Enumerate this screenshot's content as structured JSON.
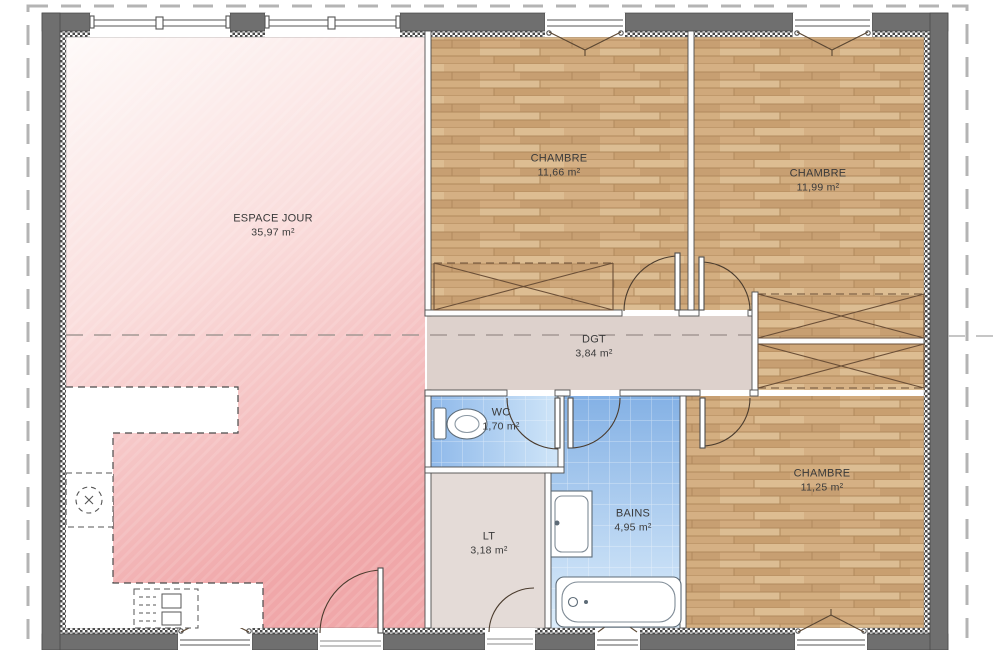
{
  "plan": {
    "rooms": [
      {
        "id": "espace-jour",
        "name": "ESPACE JOUR",
        "area": "35,97 m²"
      },
      {
        "id": "chambre-1",
        "name": "CHAMBRE",
        "area": "11,66 m²"
      },
      {
        "id": "chambre-2",
        "name": "CHAMBRE",
        "area": "11,99 m²"
      },
      {
        "id": "dgt",
        "name": "DGT",
        "area": "3,84 m²"
      },
      {
        "id": "wc",
        "name": "WC",
        "area": "1,70 m²"
      },
      {
        "id": "bains",
        "name": "BAINS",
        "area": "4,95 m²"
      },
      {
        "id": "lt",
        "name": "LT",
        "area": "3,18 m²"
      },
      {
        "id": "chambre-3",
        "name": "CHAMBRE",
        "area": "11,25 m²"
      }
    ],
    "colors": {
      "exterior_wall": "#6f6f6f",
      "living_pink": "#f2abad",
      "wood_floor": "#d2ab7e",
      "wet_room_blue": "#8ab5e8",
      "corridor": "#ddd1cc",
      "utility": "#e4dbd7",
      "boundary_dash": "#b4b4b4"
    }
  }
}
